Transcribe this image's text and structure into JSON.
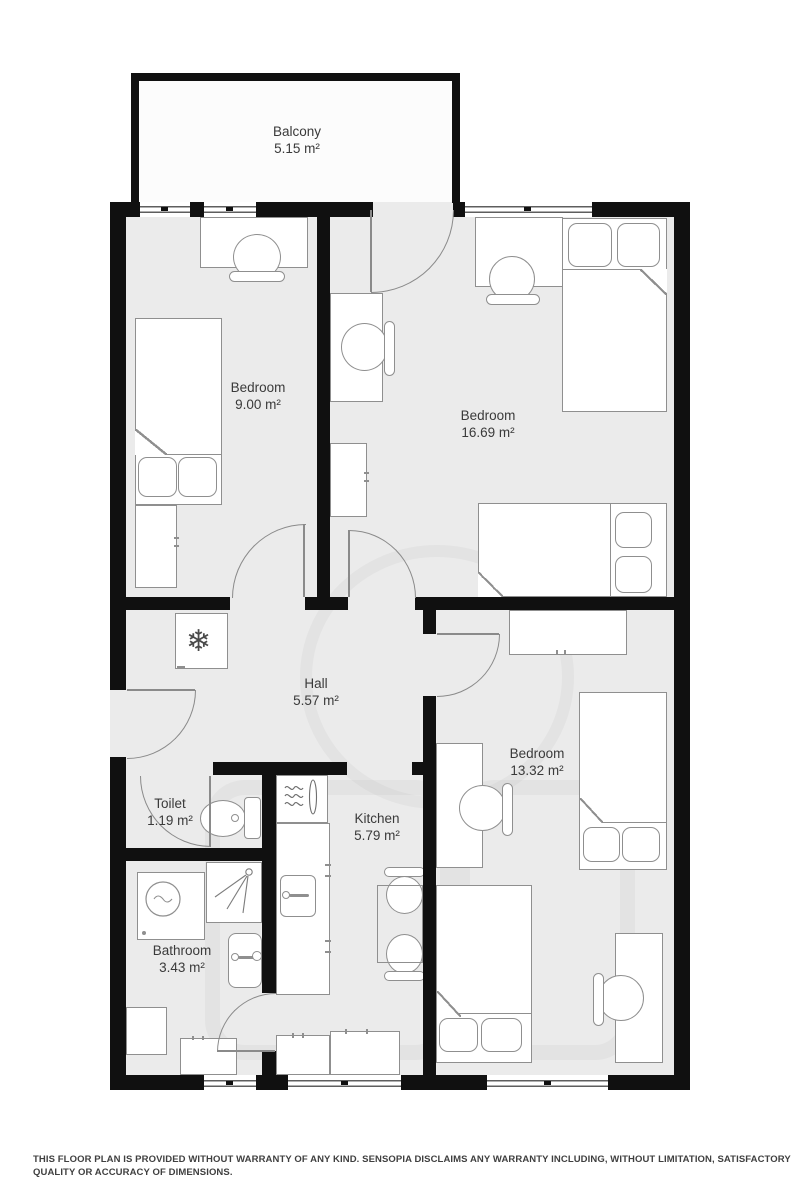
{
  "rooms": [
    {
      "name": "Balcony",
      "area": "5.15 m²"
    },
    {
      "name": "Bedroom",
      "area": "9.00 m²"
    },
    {
      "name": "Bedroom",
      "area": "16.69 m²"
    },
    {
      "name": "Hall",
      "area": "5.57 m²"
    },
    {
      "name": "Toilet",
      "area": "1.19 m²"
    },
    {
      "name": "Kitchen",
      "area": "5.79 m²"
    },
    {
      "name": "Bathroom",
      "area": "3.43 m²"
    },
    {
      "name": "Bedroom",
      "area": "13.32 m²"
    }
  ],
  "icons": {
    "fridge": "❄"
  },
  "colors": {
    "wall": "#101010",
    "floor": "#ebebeb",
    "outline": "#8f8f8f",
    "label": "#3a3a3a"
  },
  "disclaimer": "THIS FLOOR PLAN IS PROVIDED WITHOUT WARRANTY OF ANY KIND. SENSOPIA DISCLAIMS ANY WARRANTY INCLUDING, WITHOUT LIMITATION, SATISFACTORY QUALITY OR ACCURACY OF DIMENSIONS."
}
